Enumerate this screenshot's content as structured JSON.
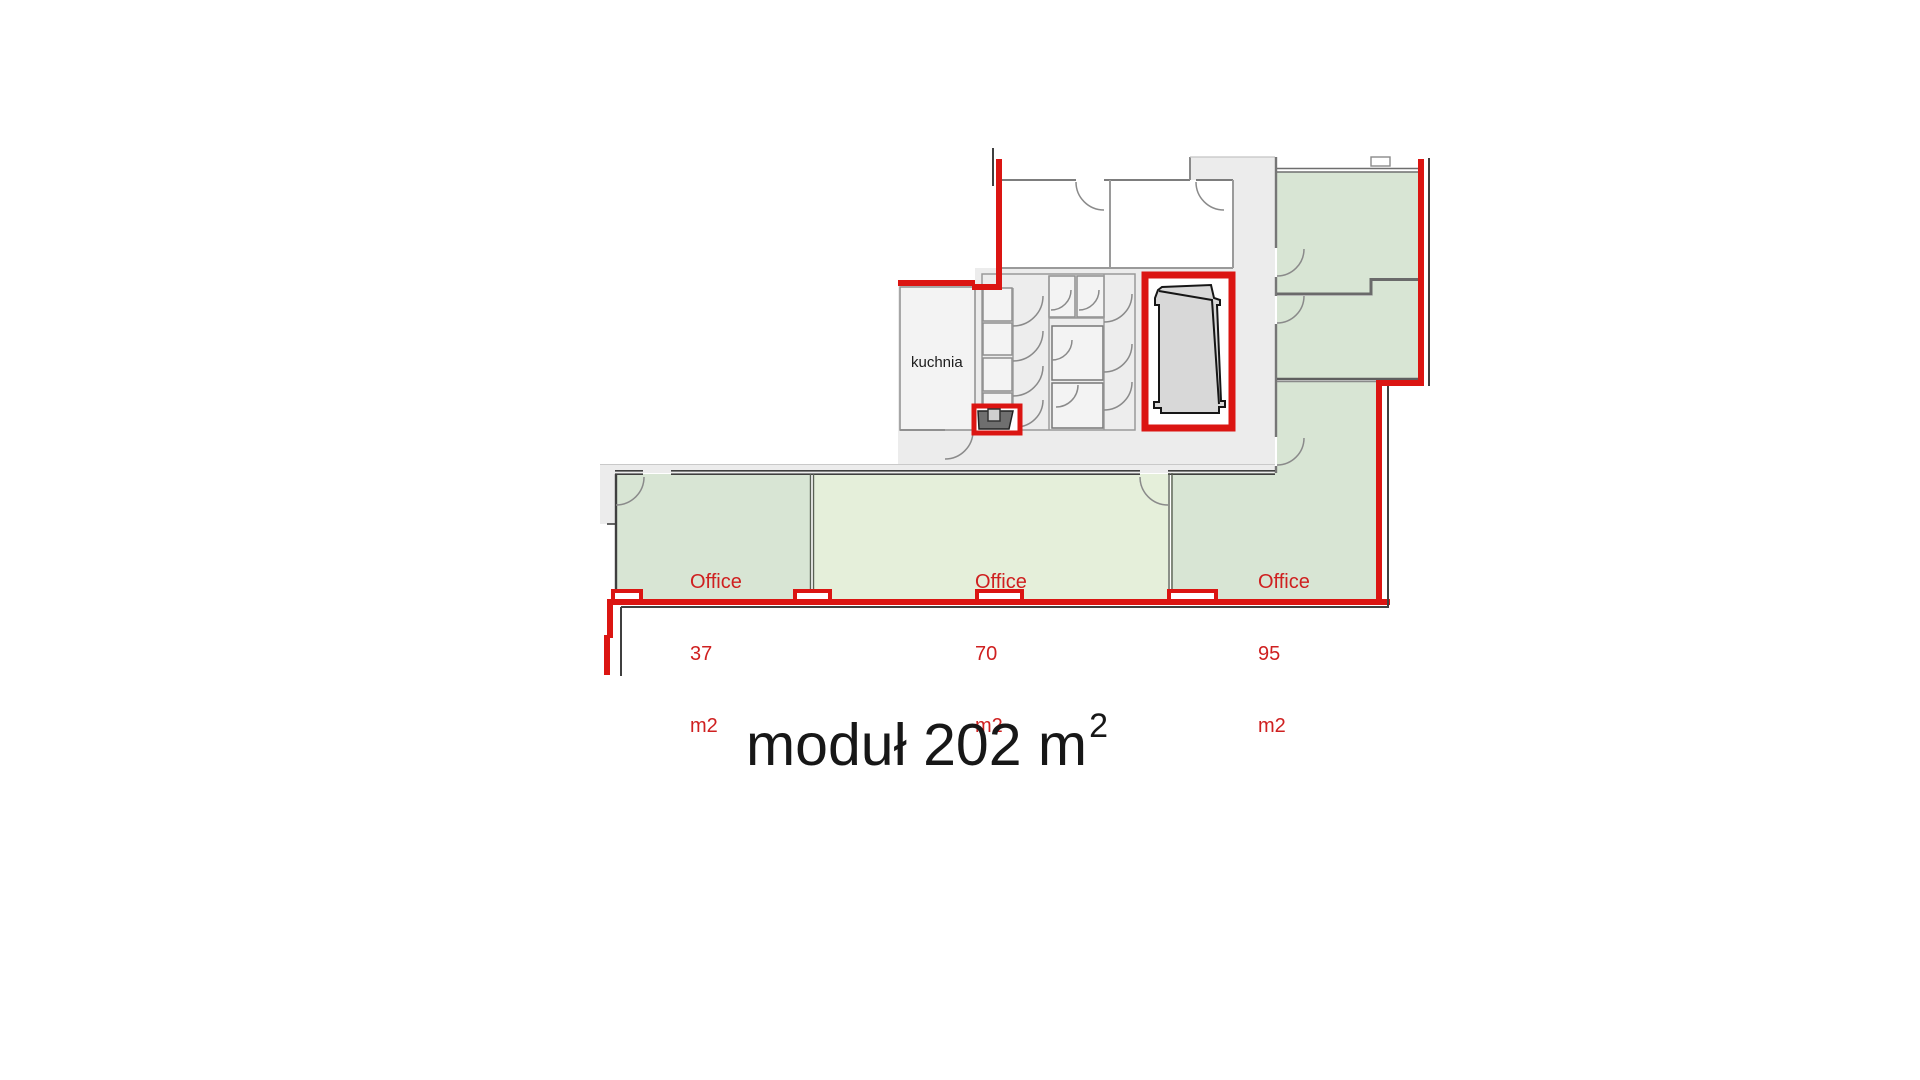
{
  "title": {
    "text": "moduł 202 m",
    "superscript": "2"
  },
  "plan": {
    "labels": {
      "kitchen": "kuchnia",
      "offices": [
        {
          "name": "Office",
          "area": "37",
          "unit": "m2"
        },
        {
          "name": "Office",
          "area": "70",
          "unit": "m2"
        },
        {
          "name": "Office",
          "area": "95",
          "unit": "m2"
        }
      ]
    },
    "colors": {
      "boundary_red": "#db1512",
      "office_sage_green": "#d8e5d4",
      "office_light_green": "#e5efda",
      "corridor_gray": "#ececec",
      "stall_gray": "#f3f3f3",
      "shaft_inner_gray": "#d8d8d8",
      "wall_gray": "#8a8a8a",
      "wall_dark": "#3f3f3f",
      "label_red": "#cf2020",
      "title_dark": "#171717"
    }
  }
}
